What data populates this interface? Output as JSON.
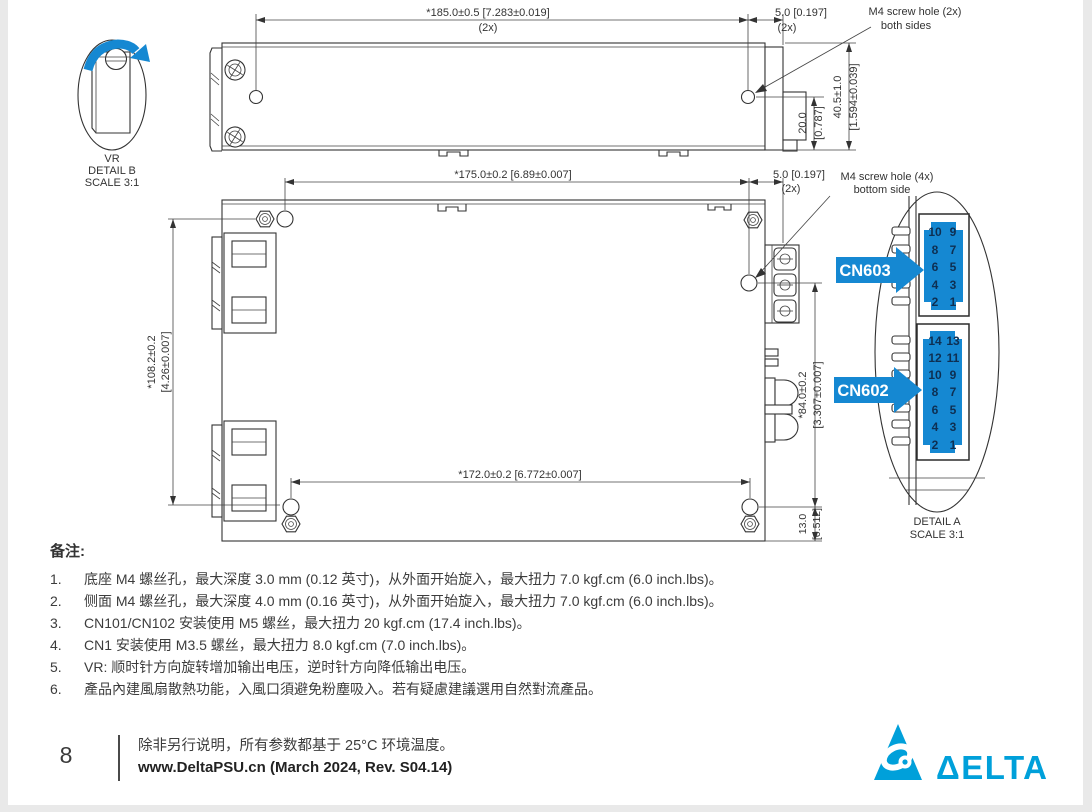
{
  "colors": {
    "accent_blue": "#1588d2",
    "logo_blue": "#00a0da",
    "line": "#333333"
  },
  "detail_b": {
    "name": "VR",
    "caption1": "DETAIL B",
    "caption2": "SCALE 3:1"
  },
  "side_view": {
    "length": "*185.0±0.5  [7.283±0.019]",
    "length_qty": "(2x)",
    "offset": "5.0  [0.197]",
    "offset_qty": "(2x)",
    "screw_note1": "M4 screw hole (2x)",
    "screw_note2": "both sides",
    "h1_mm": "20.0",
    "h1_in": "[0.787]",
    "h2_mm": "40.5±1.0",
    "h2_in": "[1.594±0.039]"
  },
  "bottom_view": {
    "length": "*175.0±0.2  [6.89±0.007]",
    "offset": "5.0  [0.197]",
    "offset_qty": "(2x)",
    "screw_note1": "M4 screw hole (4x)",
    "screw_note2": "bottom side",
    "height_mm": "*108.2±0.2",
    "height_in": "[4.26±0.007]",
    "hole_span": "*172.0±0.2  [6.772±0.007]",
    "right_mm": "*84.0±0.2",
    "right_in": "[3.307±0.007]",
    "bottom_mm": "13.0",
    "bottom_in": "[0.512]"
  },
  "detail_a": {
    "caption1": "DETAIL A",
    "caption2": "SCALE 3:1",
    "cn603": {
      "label": "CN603",
      "pins": [
        "10",
        "9",
        "8",
        "7",
        "6",
        "5",
        "4",
        "3",
        "2",
        "1"
      ]
    },
    "cn602": {
      "label": "CN602",
      "pins": [
        "14",
        "13",
        "12",
        "11",
        "10",
        "9",
        "8",
        "7",
        "6",
        "5",
        "4",
        "3",
        "2",
        "1"
      ]
    }
  },
  "notes": {
    "title": "备注:",
    "items": [
      {
        "num": "1.",
        "text": "底座 M4 螺丝孔，最大深度 3.0 mm  (0.12 英寸)，从外面开始旋入，最大扭力 7.0 kgf.cm (6.0 inch.lbs)。"
      },
      {
        "num": "2.",
        "text": "侧面 M4 螺丝孔，最大深度 4.0 mm  (0.16 英寸)，从外面开始旋入，最大扭力 7.0 kgf.cm (6.0 inch.lbs)。"
      },
      {
        "num": "3.",
        "text": "CN101/CN102 安装使用 M5 螺丝，最大扭力 20 kgf.cm (17.4 inch.lbs)。"
      },
      {
        "num": "4.",
        "text": "CN1 安装使用 M3.5 螺丝，最大扭力 8.0 kgf.cm (7.0 inch.lbs)。"
      },
      {
        "num": "5.",
        "text": "VR: 顺时针方向旋转增加输出电压，逆时针方向降低输出电压。"
      },
      {
        "num": "6.",
        "text": "產品內建風扇散熱功能，入風口須避免粉塵吸入。若有疑慮建議選用自然對流產品。"
      }
    ]
  },
  "footer": {
    "page_number": "8",
    "line1": "除非另行说明，所有参数都基于 25°C 环境温度。",
    "line2": "www.DeltaPSU.cn (March 2024, Rev. S04.14)"
  },
  "logo": {
    "wordmark": "ΔELTA"
  }
}
